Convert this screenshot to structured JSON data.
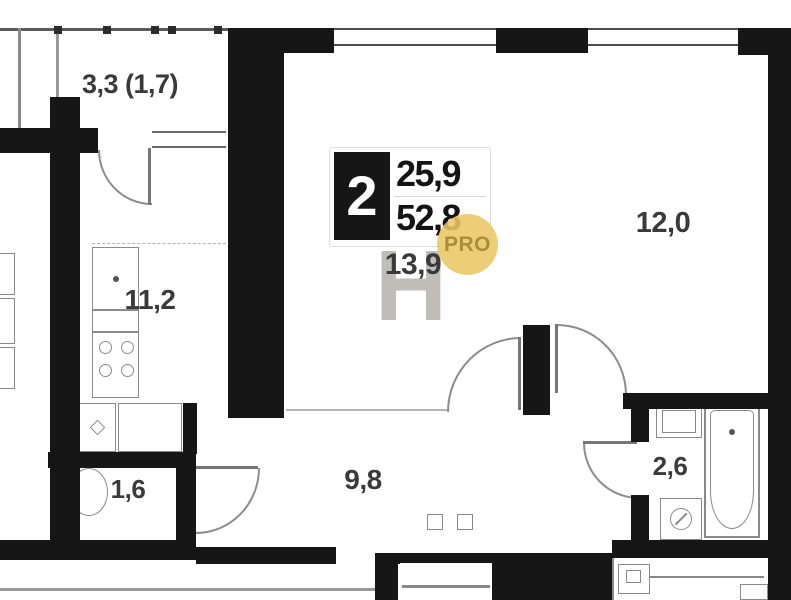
{
  "floorplan": {
    "unit": {
      "rooms_count": "2",
      "area_living": "25,9",
      "area_total": "52,8"
    },
    "rooms": [
      {
        "id": "balcony",
        "label": "3,3 (1,7)"
      },
      {
        "id": "kitchen",
        "label": "11,2"
      },
      {
        "id": "wc",
        "label": "1,6"
      },
      {
        "id": "hallway",
        "label": "9,8"
      },
      {
        "id": "living-room",
        "label": "13,9"
      },
      {
        "id": "bedroom",
        "label": "12,0"
      },
      {
        "id": "bathroom",
        "label": "2,6"
      }
    ],
    "watermark": {
      "letter": "Н",
      "pro": "PRO"
    },
    "colors": {
      "wall": "#161616",
      "fixture_line": "#8a8a8a",
      "pro_gold": "#e9c767",
      "pro_text": "#a98e3a",
      "label": "#3a3a3a"
    }
  }
}
